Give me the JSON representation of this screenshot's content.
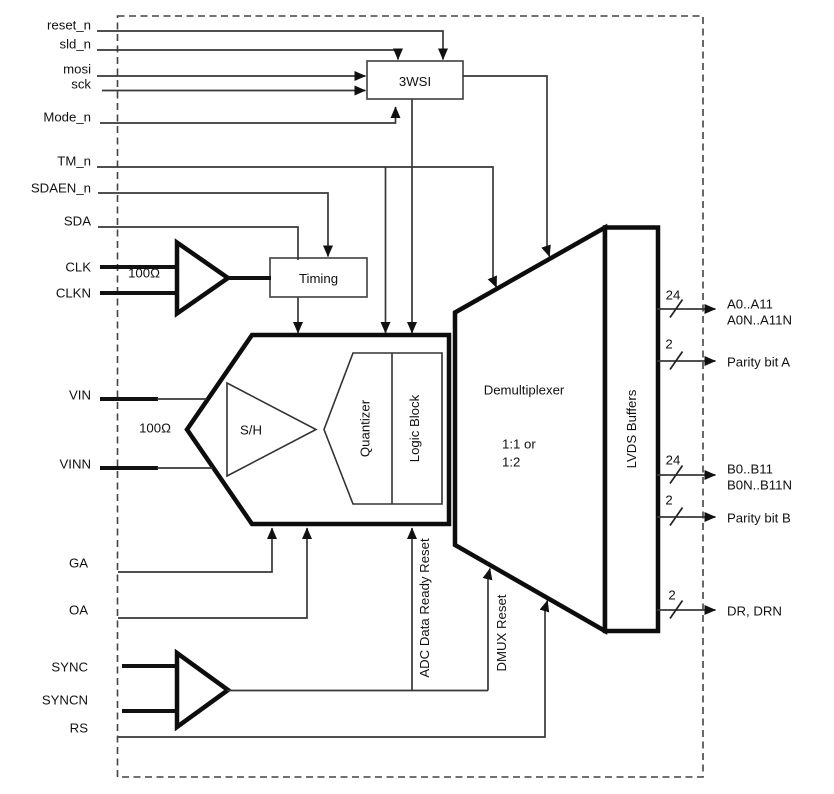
{
  "diagram": {
    "signals": {
      "reset_n": "reset_n",
      "sld_n": "sld_n",
      "mosi": "mosi",
      "sck": "sck",
      "mode_n": "Mode_n",
      "tm_n": "TM_n",
      "sdaen_n": "SDAEN_n",
      "sda": "SDA",
      "clk": "CLK",
      "clkn": "CLKN",
      "vin": "VIN",
      "vinn": "VINN",
      "ga": "GA",
      "oa": "OA",
      "sync": "SYNC",
      "syncn": "SYNCN",
      "rs": "RS"
    },
    "blocks": {
      "wsi": "3WSI",
      "timing": "Timing",
      "sample_hold": "S/H",
      "quantizer": "Quantizer",
      "logic_block": "Logic Block",
      "demultiplexer": "Demultiplexer",
      "demux_ratio_line1": "1:1 or",
      "demux_ratio_line2": "1:2",
      "lvds_buffers": "LVDS Buffers"
    },
    "annotations": {
      "clk_termination": "100Ω",
      "vin_termination": "100Ω",
      "adc_data_ready_reset": "ADC Data Ready Reset",
      "dmux_reset": "DMUX Reset"
    },
    "outputs": {
      "bus_a": {
        "width": "24",
        "line1": "A0..A11",
        "line2": "A0N..A11N"
      },
      "parity_a": {
        "width": "2",
        "label": "Parity bit A"
      },
      "bus_b": {
        "width": "24",
        "line1": "B0..B11",
        "line2": "B0N..B11N"
      },
      "parity_b": {
        "width": "2",
        "label": "Parity bit B"
      },
      "data_ready": {
        "width": "2",
        "label": "DR, DRN"
      }
    }
  }
}
